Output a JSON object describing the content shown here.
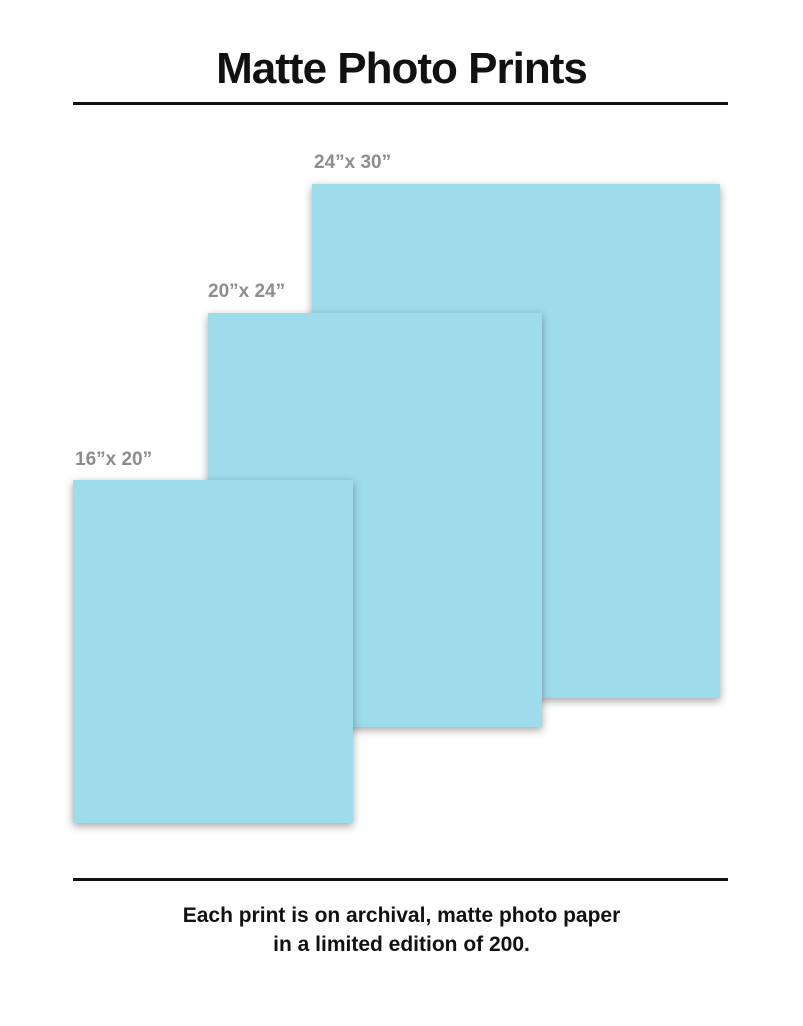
{
  "page": {
    "title": "Matte Photo Prints",
    "caption_line1": "Each print is on archival, matte photo paper",
    "caption_line2": "in a limited edition of 200."
  },
  "prints": [
    {
      "label": "24”x 30”",
      "width_in": 24,
      "height_in": 30
    },
    {
      "label": "20”x 24”",
      "width_in": 20,
      "height_in": 24
    },
    {
      "label": "16”x 20”",
      "width_in": 16,
      "height_in": 20
    }
  ],
  "colors": {
    "print_fill": "#9edbeb",
    "label_gray": "#8d8d8d",
    "text_black": "#111111",
    "background": "#ffffff"
  }
}
